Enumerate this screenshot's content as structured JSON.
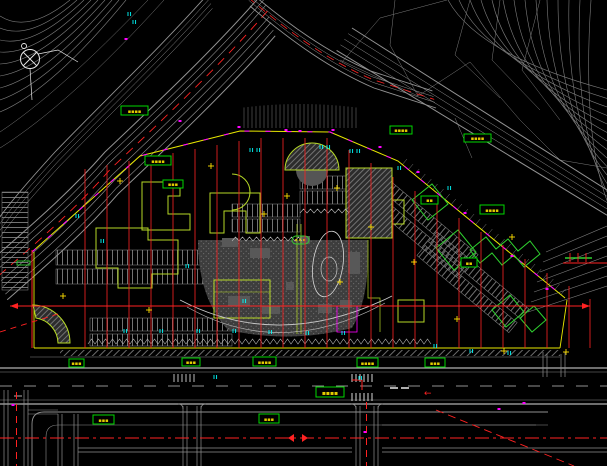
{
  "document": {
    "type": "cad-site-plan-screenshot",
    "canvas": {
      "width": 607,
      "height": 466
    },
    "background": "#000000"
  },
  "colors": {
    "contour_gray": "#7d7d7d",
    "road_gray": "#939393",
    "building_yellow_green": "#b6d926",
    "cluster_green": "#2fd12f",
    "label_box_green": "#00d800",
    "label_text_yellow": "#e3cc00",
    "boundary_yellow": "#e8e800",
    "grid_red": "#ff2222",
    "marker_cyan": "#00ffff",
    "marker_magenta": "#ff00ff",
    "marking_white": "#e0e0e0",
    "plaza_gray": "#3d3d3d"
  },
  "north_arrow": {
    "type": "compass-cross"
  },
  "labels": [
    {
      "text": "▪▪▪▪"
    },
    {
      "text": "▪▪▪▪"
    },
    {
      "text": "▪▪▪"
    },
    {
      "text": "▪▪▪▪"
    },
    {
      "text": "▪▪▪▪"
    },
    {
      "text": "▪▪"
    },
    {
      "text": "▪▪▪▪"
    },
    {
      "text": "▪▪"
    },
    {
      "text": "▪▪▪"
    },
    {
      "text": "▪▪▪"
    },
    {
      "text": "▪▪▪▪"
    },
    {
      "text": "▪▪▪▪"
    },
    {
      "text": "▪▪▪"
    },
    {
      "text": "▪▪▪▪"
    },
    {
      "text": "▪▪▪"
    },
    {
      "text": "▪▪▪"
    }
  ],
  "road_markings": {
    "left_arrow": "←"
  }
}
